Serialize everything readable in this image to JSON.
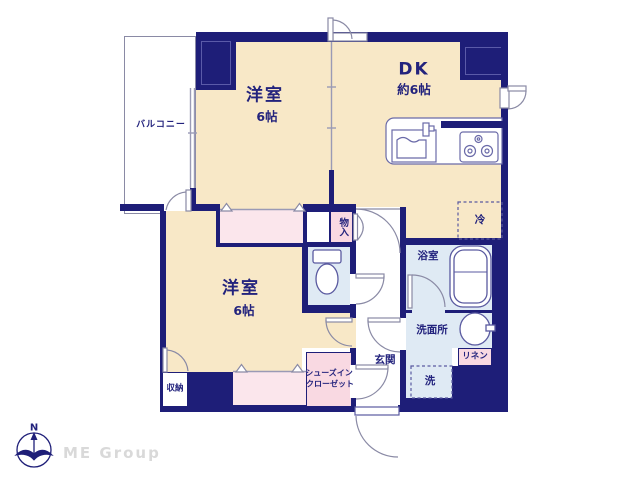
{
  "plan": {
    "balcony": {
      "label": "バルコニー"
    },
    "bedroom_top": {
      "label": "洋室",
      "size": "6帖"
    },
    "dk": {
      "label": "DK",
      "size": "約6帖"
    },
    "bedroom_bottom": {
      "label": "洋室",
      "size": "6帖"
    },
    "storage_mid": {
      "label": "物入"
    },
    "fridge": {
      "label": "冷"
    },
    "bathroom": {
      "label": "浴室"
    },
    "washroom": {
      "label": "洗面所"
    },
    "linen": {
      "label": "リネン"
    },
    "laundry": {
      "label": "洗"
    },
    "entrance": {
      "label": "玄関"
    },
    "shoes_closet": {
      "label_line1": "シューズイン",
      "label_line2": "クローゼット"
    },
    "storage_bottom": {
      "label": "収納"
    }
  },
  "branding": {
    "logo_text": "ME Group",
    "compass_label": "N"
  },
  "colors": {
    "wall_navy": "#1e1e78",
    "room_cream": "#f8e8c7",
    "wet_blue": "#dfeaf4",
    "closet_pink": "#fbe6ec",
    "logo_gray": "#d9d9d9"
  }
}
